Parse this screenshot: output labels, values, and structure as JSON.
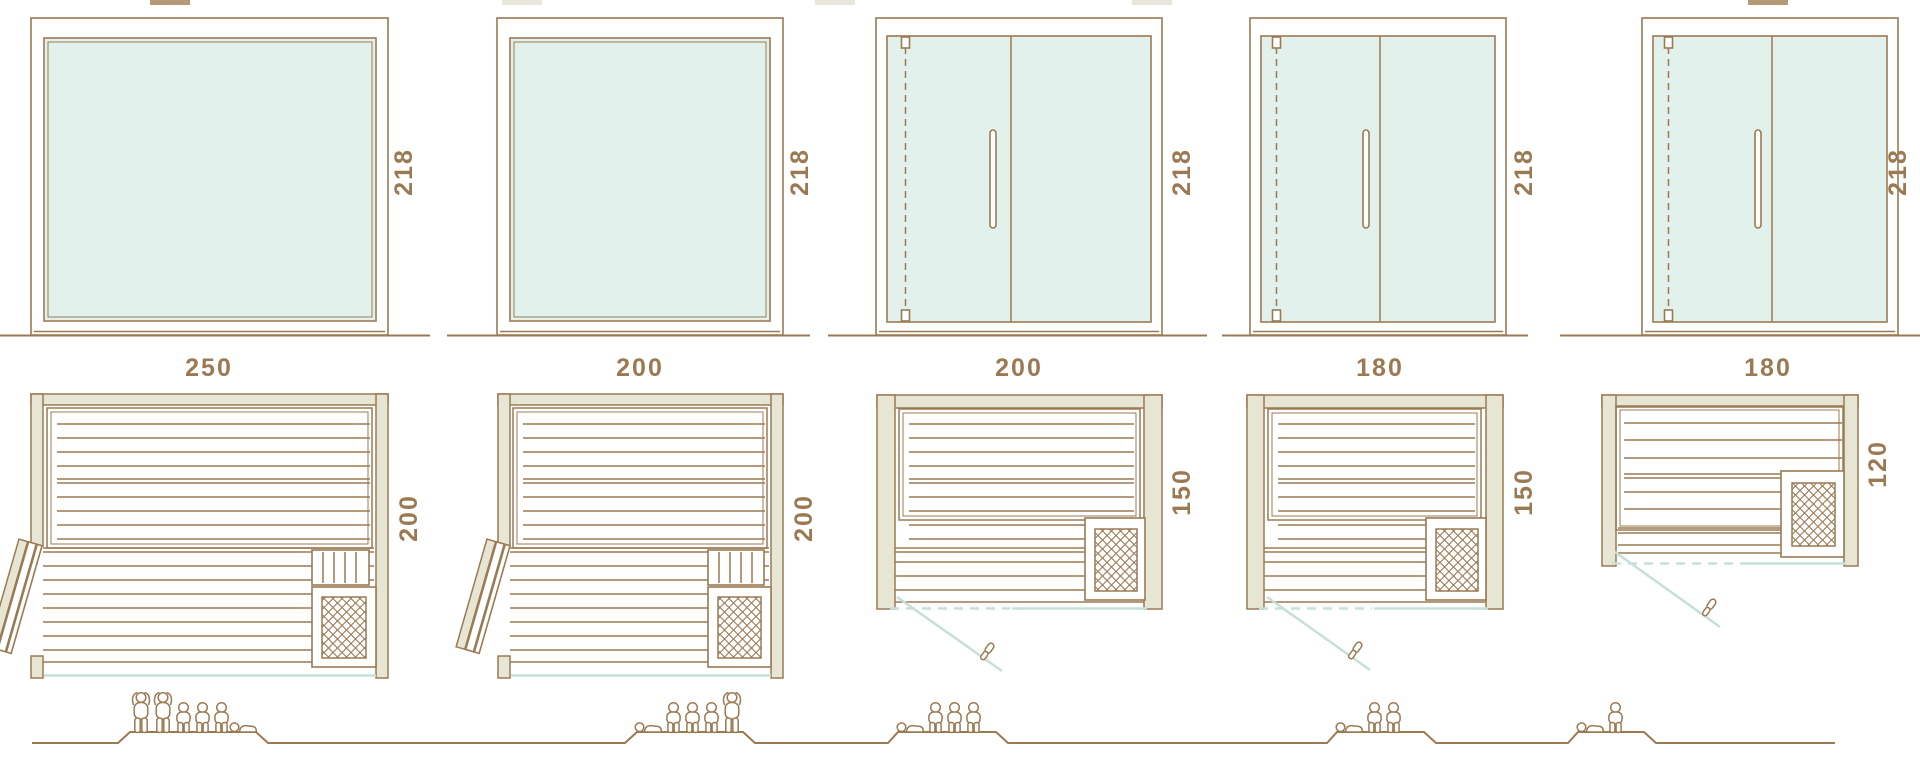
{
  "diagram": {
    "description": "Sauna cabin size comparison: front elevations, floor plans and seating-capacity pictograms",
    "rows": [
      "front-elevation",
      "floor-plan",
      "capacity-pictogram"
    ]
  },
  "colors": {
    "line_brown": "#9b7a53",
    "wall_fill": "#e7e5d3",
    "glass_fill": "#e3f1ed",
    "accent_cyan": "#c6e0d9",
    "text": "#9b7a53"
  },
  "columns": [
    {
      "front": {
        "width_label": "250",
        "height_label": "218",
        "style": "fixed-glass-panel"
      },
      "plan": {
        "depth_label": "200",
        "heater": "bottom-right",
        "door": "hinged-door-open-left"
      },
      "capacity": {
        "standing": 2,
        "sitting": 3,
        "lying": 1,
        "total": 6
      },
      "people": [
        "stand",
        "stand",
        "sit",
        "sit",
        "sit",
        "lie"
      ]
    },
    {
      "front": {
        "width_label": "200",
        "height_label": "218",
        "style": "fixed-glass-panel"
      },
      "plan": {
        "depth_label": "200",
        "heater": "bottom-right",
        "door": "hinged-door-open-left"
      },
      "capacity": {
        "standing": 1,
        "sitting": 3,
        "lying": 1,
        "total": 5
      },
      "people": [
        "lie",
        "sit",
        "sit",
        "sit",
        "stand"
      ]
    },
    {
      "front": {
        "width_label": "200",
        "height_label": "218",
        "style": "glass-door-two-panes"
      },
      "plan": {
        "depth_label": "150",
        "heater": "bottom-right",
        "door": "glass-door-swing-out"
      },
      "capacity": {
        "standing": 0,
        "sitting": 3,
        "lying": 1,
        "total": 4
      },
      "people": [
        "lie",
        "sit",
        "sit",
        "sit"
      ]
    },
    {
      "front": {
        "width_label": "180",
        "height_label": "218",
        "style": "glass-door-two-panes"
      },
      "plan": {
        "depth_label": "150",
        "heater": "bottom-right",
        "door": "glass-door-swing-out"
      },
      "capacity": {
        "standing": 0,
        "sitting": 2,
        "lying": 1,
        "total": 3
      },
      "people": [
        "lie",
        "sit",
        "sit"
      ]
    },
    {
      "front": {
        "width_label": "180",
        "height_label": "218",
        "style": "glass-door-two-panes"
      },
      "plan": {
        "depth_label": "120",
        "heater": "mid-right",
        "door": "glass-door-swing-out"
      },
      "capacity": {
        "standing": 0,
        "sitting": 1,
        "lying": 1,
        "total": 2
      },
      "people": [
        "lie",
        "sit"
      ]
    }
  ],
  "icons": {
    "person_standing": "person-standing-icon",
    "person_sitting": "person-sitting-icon",
    "person_lying": "person-lying-icon",
    "heater": "heater-lattice-icon",
    "door_handle": "door-handle-icon"
  }
}
